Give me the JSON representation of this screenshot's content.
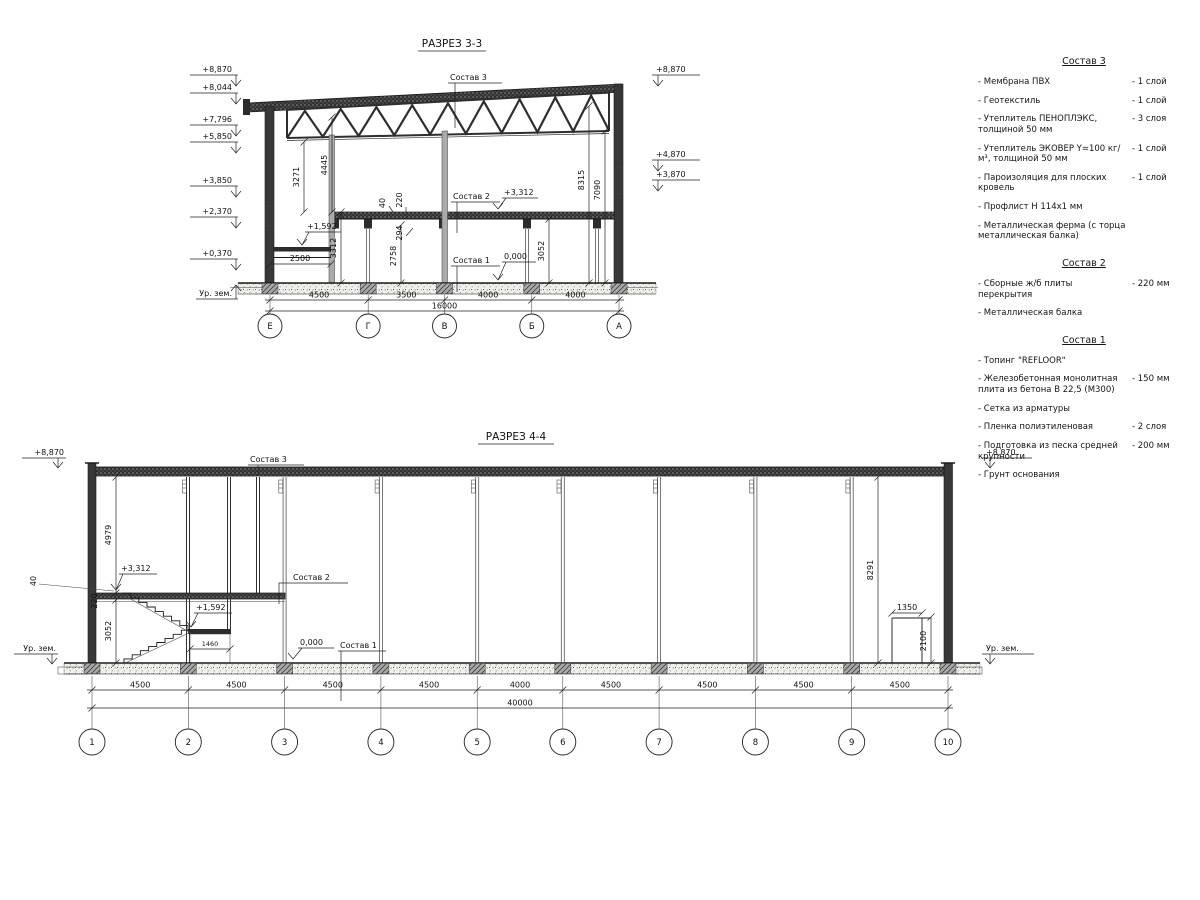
{
  "s3": {
    "title": "РАЗРЕЗ 3-3",
    "elev_left": [
      "+8,870",
      "+8,044",
      "+7,796",
      "+5,850",
      "+3,850",
      "+2,370",
      "+0,370"
    ],
    "ground_left": "Ур. зем.",
    "elev_right": [
      "+8,870",
      "+4,870",
      "+3,870"
    ],
    "labels": {
      "sostav3": "Состав 3",
      "sostav2": "Состав 2",
      "sostav1": "Состав 1",
      "lvl3312": "+3,312",
      "lvl1592": "+1,592",
      "lvl0": "0,000"
    },
    "dims": {
      "d3271": "3271",
      "d4445": "4445",
      "d3312": "3312",
      "d40": "40",
      "d220": "220",
      "d294": "294",
      "d2758": "2758",
      "d3052": "3052",
      "d8315": "8315",
      "d7090": "7090",
      "d2500": "2500"
    },
    "axes": [
      "Е",
      "Г",
      "В",
      "Б",
      "А"
    ],
    "spans": [
      4500,
      3500,
      4000,
      4000
    ],
    "span_labels": [
      "4500",
      "3500",
      "4000",
      "4000"
    ],
    "total": "16000"
  },
  "s4": {
    "title": "РАЗРЕЗ 4-4",
    "elev_left": "+8,870",
    "ground_left": "Ур. зем.",
    "elev_right": "+8,870",
    "ground_right": "Ур. зем.",
    "labels": {
      "sostav3": "Состав 3",
      "sostav2": "Состав 2",
      "sostav1": "Состав 1",
      "lvl3312": "+3,312",
      "lvl1592": "+1,592",
      "lvl0": "0,000"
    },
    "dims": {
      "d4979": "4979",
      "d3052": "3052",
      "d220": "220",
      "d40": "40",
      "d1460": "1460",
      "d8291": "8291",
      "d1350": "1350",
      "d2100": "2100"
    },
    "axes": [
      "1",
      "2",
      "3",
      "4",
      "5",
      "6",
      "7",
      "8",
      "9",
      "10"
    ],
    "spans": [
      4500,
      4500,
      4500,
      4500,
      4000,
      4500,
      4500,
      4500,
      4500
    ],
    "span_labels": [
      "4500",
      "4500",
      "4500",
      "4500",
      "4000",
      "4500",
      "4500",
      "4500",
      "4500"
    ],
    "total": "40000"
  },
  "legend": {
    "s3": {
      "title": "Состав 3",
      "items": [
        {
          "name": "- Мембрана ПВХ",
          "qty": "- 1 слой"
        },
        {
          "name": "- Геотекстиль",
          "qty": "- 1 слой"
        },
        {
          "name": "- Утеплитель ПЕНОПЛЭКС, толщиной 50 мм",
          "qty": "- 3 слоя"
        },
        {
          "name": "- Утеплитель ЭКОВЕР Y=100 кг/м³, толщиной 50 мм",
          "qty": "- 1 слой"
        },
        {
          "name": "- Пароизоляция для плоских кровель",
          "qty": "- 1 слой"
        },
        {
          "name": "- Профлист Н 114х1 мм",
          "qty": ""
        },
        {
          "name": "- Металлическая ферма (с торца металлическая балка)",
          "qty": ""
        }
      ]
    },
    "s2": {
      "title": "Состав 2",
      "items": [
        {
          "name": "- Сборные ж/б плиты перекрытия",
          "qty": "- 220 мм"
        },
        {
          "name": "- Металлическая балка",
          "qty": ""
        }
      ]
    },
    "s1": {
      "title": "Состав 1",
      "items": [
        {
          "name": "- Топинг \"REFLOOR\"",
          "qty": ""
        },
        {
          "name": "- Железобетонная монолитная плита из бетона В 22,5 (М300)",
          "qty": "- 150 мм"
        },
        {
          "name": "- Сетка из арматуры",
          "qty": ""
        },
        {
          "name": "- Пленка полиэтиленовая",
          "qty": "- 2 слоя"
        },
        {
          "name": "- Подготовка из песка средней крупности",
          "qty": "- 200 мм"
        },
        {
          "name": "- Грунт основания",
          "qty": ""
        }
      ]
    }
  }
}
